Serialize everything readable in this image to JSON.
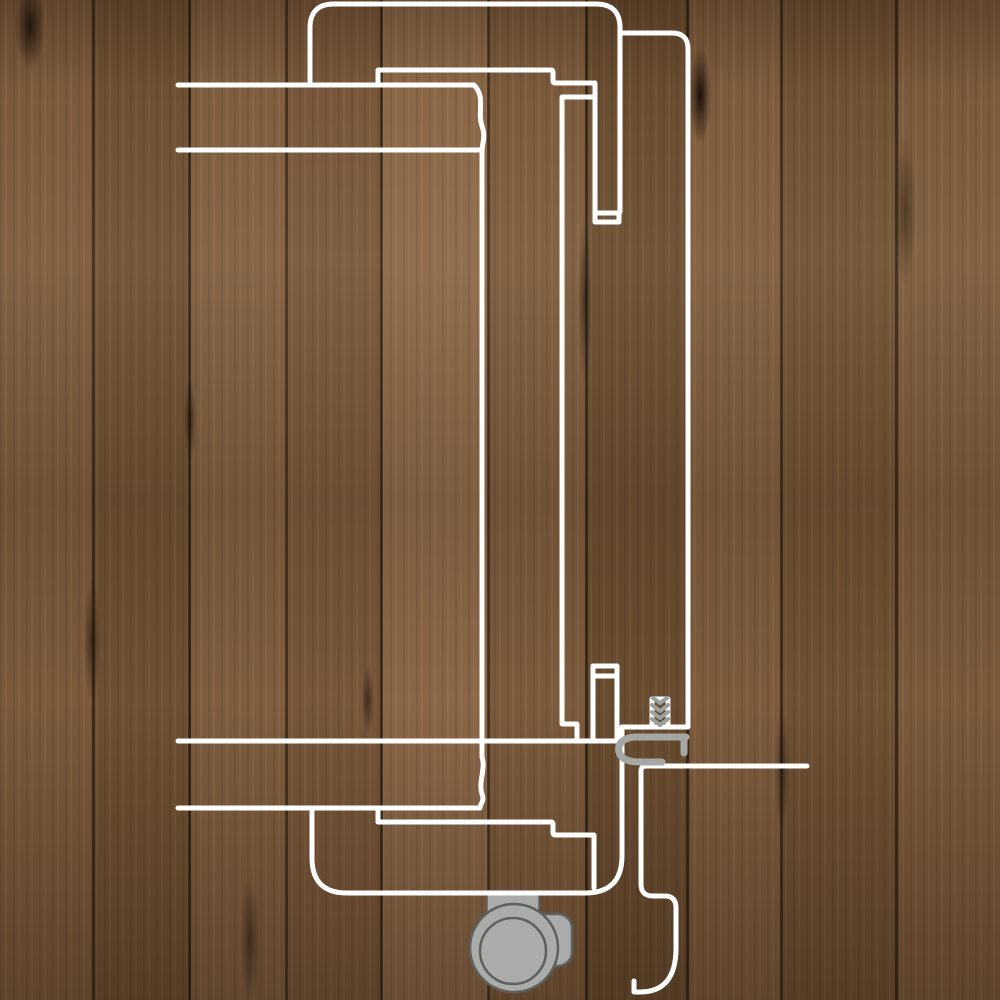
{
  "title": "Sliding door system cross-section diagram",
  "colors": {
    "line": "#ffffff",
    "hardware_fill": "#a9aca9",
    "hardware_outline": "#5d615e",
    "hardware_line": "#a4a7a4",
    "screw_thread": "#9aa09b",
    "wood_base": "#7b5a3b"
  },
  "widths": {
    "line": 5,
    "profile": 7,
    "thread": 4,
    "ring": 2.5,
    "tab_outline": 1.5
  },
  "paths": {
    "panel_main_top": "M310,85 L310,28 Q310,4 334,4 L596,4 Q620,4 620,28 L620,212",
    "panel_main_bottom": "M312,808 L312,858 Q312,893 347,893 L585,893 Q622,893 622,856 L622,727",
    "panel_secondary": "M622,33 L672,33 Q688,33 688,49 L688,727 L622,727",
    "wall_section_line": "M178,85 L474,85 C486,97 477,112 482,126 C486,138 482,142 482,152 L482,757 C486,769 478,782 482,794 C485,802 480,803 480,808",
    "wall_inner_line": "M178,150 L482,150",
    "floor_line_upper": "M178,741 L622,741",
    "floor_line_lower": "M178,808 L480,808",
    "track_step_top": "M378,85 L378,70 L551,70 Q553,70 553,72 L553,81 Q553,83 555,83 L595,83 L595,222 L619,222 L619,213 L595,213",
    "track_inner_top": "M594,97 L562,97 L562,724 L577,724 L577,741",
    "frame_post_bottom": "M593,741 L593,666 L617,666 L617,741 M593,676 L617,676",
    "track_step_bottom": "M378,808 L378,822 L551,822 Q553,822 553,824 L553,833 Q553,835 555,835 L594,835 L594,888",
    "roller_housing": "M807,766 L646,766 Q641,766 641,771 L641,884 Q641,896 653,896 L665,896 Q676,896 676,908 L676,948 Q676,992 640,992 L634,992 L634,981",
    "screw_outline": "M652,727 L652,699 L668,699 L668,727",
    "screw_threads": "M653,698 L660,703 L667,698 M652,705 L660,711 L668,705 M652,712 L660,718 L668,712 M652,719 L660,725 L668,719",
    "guide_profile": "M686,737 L637,737 C623,737 617,744 619,752 C621,760 630,762 640,762 L662,762 M684,740 L684,753"
  },
  "shapes": {
    "roller_tab": {
      "x": 487,
      "y": 891,
      "width": 52,
      "height": 21
    },
    "roller_arm": {
      "x": 530,
      "y": 914,
      "width": 42,
      "height": 52,
      "rx": 14
    },
    "wheel": {
      "cx": 514,
      "cy": 948,
      "r": 44
    },
    "wheel_hub": {
      "cx": 513,
      "cy": 951,
      "r": 33
    }
  },
  "canvas": {
    "width": 1000,
    "height": 1000
  }
}
